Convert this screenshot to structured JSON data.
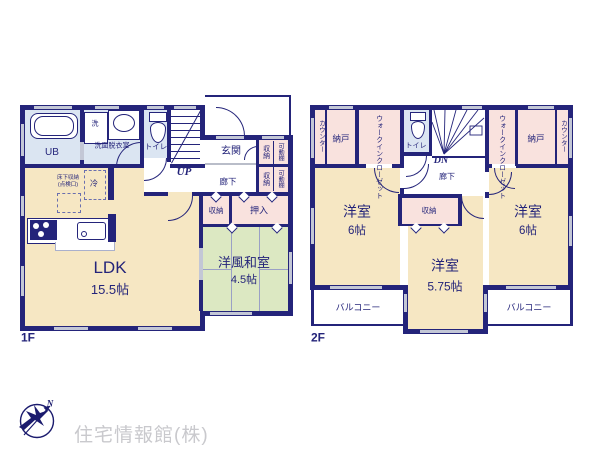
{
  "colors": {
    "wall": "#24247a",
    "room_cream": "#f6e7c3",
    "room_green": "#dce8c2",
    "room_blue": "#dbe5f2",
    "room_pink": "#f9e2de",
    "window_gray": "#c3c7d6",
    "logo_text_gray": "#c9c9cd"
  },
  "floor1": {
    "label": "1F",
    "rooms": {
      "ub": "UB",
      "washer": "洗",
      "washroom": "洗面脱衣室",
      "toilet": "トイレ",
      "stairs_up": "UP",
      "genkan": "玄関",
      "hallway": "廊下",
      "storage_top": "収納",
      "shelf_top": "可動棚",
      "storage_bottom": "収納",
      "shelf_bottom": "可動棚",
      "underfloor_line1": "床下収納",
      "underfloor_line2": "(点検口)",
      "fridge": "冷",
      "ldk": "LDK",
      "ldk_size": "15.5帖",
      "storage_mid": "収納",
      "oshiire": "押入",
      "washitsu": "洋風和室",
      "washitsu_size": "4.5帖"
    }
  },
  "floor2": {
    "label": "2F",
    "rooms": {
      "counter_left": "カウンター",
      "nando_left": "納戸",
      "wic_left": "ウォークインクローゼット",
      "toilet": "トイレ",
      "stairs_down": "DN",
      "hallway": "廊下",
      "wic_right": "ウォークインクローゼット",
      "nando_right": "納戸",
      "counter_right": "カウンター",
      "bedroom_left": "洋室",
      "bedroom_left_size": "6帖",
      "storage_center": "収納",
      "bedroom_center": "洋室",
      "bedroom_center_size": "5.75帖",
      "bedroom_right": "洋室",
      "bedroom_right_size": "6帖",
      "balcony_left": "バルコニー",
      "balcony_right": "バルコニー"
    }
  },
  "footer": {
    "company": "住宅情報館(株)",
    "north": "N"
  }
}
